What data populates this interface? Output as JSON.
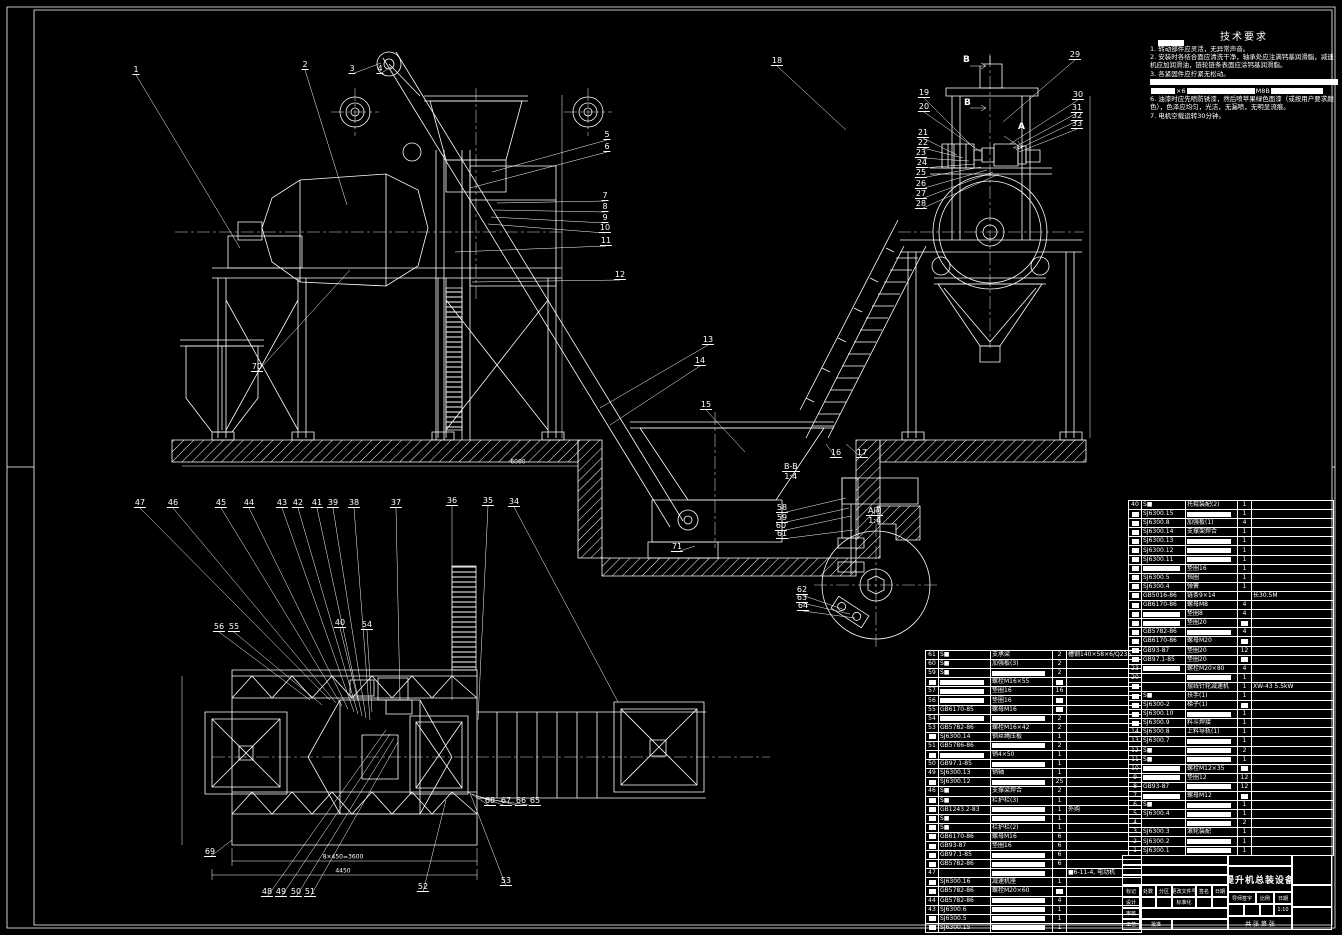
{
  "colors": {
    "background": "#000000",
    "line": "#ffffff"
  },
  "tech_requirements": {
    "title": "技术要求",
    "lines": [
      {
        "text": "1. 转动部件应灵活，无异常声音。"
      },
      {
        "text": "2. 安装时各结合面应清洗干净，轴承处应注满钙基润滑脂，减速机应加润滑油，链轮链条表面应涂钙基润滑脂。"
      },
      {
        "text": "3. 各紧固件应拧紧无松动。"
      },
      {
        "bar": true
      },
      {
        "parts": [
          {
            "b": 24
          },
          {
            "t": "×6"
          },
          {
            "b": 68
          },
          {
            "t": "M8B"
          },
          {
            "b": 52
          }
        ]
      },
      {
        "text": "6. 油漆时应先喷防锈漆，然后喷苹果绿色面漆（或按用户要求颜色），色泽应均匀，光洁，无漏喷，无明显流痕。"
      },
      {
        "text": "7. 电机空载运转30分钟。"
      }
    ]
  },
  "sections": {
    "bb_label": "B-B",
    "bb_scale": "1:4",
    "a_label": "A向",
    "a_scale": "1:4",
    "cut_letter_top": "B",
    "cut_letter_bottom": "B",
    "view_letter": "A"
  },
  "dims": [
    "6000",
    "8×450=3600",
    "4450"
  ],
  "callouts": [
    "1",
    "2",
    "3",
    "4",
    "18",
    "29",
    "5",
    "6",
    "19",
    "20",
    "30",
    "31",
    "32",
    "33",
    "7",
    "8",
    "9",
    "10",
    "11",
    "12",
    "21",
    "22",
    "23",
    "24",
    "25",
    "26",
    "27",
    "28",
    "13",
    "14",
    "15",
    "70",
    "16",
    "17",
    "71",
    "58",
    "59",
    "60",
    "61",
    "62",
    "63",
    "64",
    "47",
    "46",
    "45",
    "44",
    "43",
    "42",
    "41",
    "39",
    "38",
    "37",
    "36",
    "35",
    "34",
    "56",
    "55",
    "40",
    "54",
    "69",
    "48",
    "49",
    "50",
    "51",
    "52",
    "53",
    "68",
    "67",
    "66",
    "65"
  ],
  "bom_right": {
    "rows": [
      [
        "40",
        "S■",
        "托辊装配(2)",
        "1",
        ""
      ],
      [
        "■",
        "SJ6300.15",
        "■",
        "1",
        ""
      ],
      [
        "■",
        "SJ6300.8",
        "加强板(1)",
        "4",
        ""
      ],
      [
        "■",
        "SJ6300.14",
        "支撑架焊合",
        "1",
        ""
      ],
      [
        "■",
        "SJ6300.13",
        "■",
        "1",
        ""
      ],
      [
        "■",
        "SJ6300.12",
        "■",
        "1",
        ""
      ],
      [
        "■",
        "SJ6300.11",
        "■",
        "1",
        ""
      ],
      [
        "■",
        "■",
        "垫圈16",
        "1",
        ""
      ],
      [
        "■",
        "SJ6300.5",
        "挡圈",
        "1",
        ""
      ],
      [
        "■",
        "SJ6300.4",
        "弹簧",
        "1",
        ""
      ],
      [
        "■",
        "GB5016-86",
        "链条9×14",
        "",
        "长30.5M"
      ],
      [
        "■",
        "GB6170-86",
        "螺母M8",
        "4",
        ""
      ],
      [
        "■",
        "■",
        "垫圈8",
        "4",
        ""
      ],
      [
        "■",
        "■",
        "垫圈20",
        "■",
        ""
      ],
      [
        "■",
        "GB5782-86",
        "■",
        "4",
        ""
      ],
      [
        "■",
        "GB6170-86",
        "螺母M20",
        "■",
        ""
      ],
      [
        "■",
        "GB93-87",
        "垫圈20",
        "12",
        ""
      ],
      [
        "■",
        "GB97.1-85",
        "垫圈20",
        "■",
        ""
      ],
      [
        "23",
        "■",
        "螺栓M20×80",
        "4",
        ""
      ],
      [
        "20",
        "",
        "■",
        "1",
        ""
      ],
      [
        "■",
        "",
        "摆线针轮减速机",
        "1",
        "XW-43 5.5kW"
      ],
      [
        "■",
        "S■",
        "扶手(1)",
        "1",
        ""
      ],
      [
        "■",
        "SJ6300-2",
        "梯子(1)",
        "■",
        ""
      ],
      [
        "■",
        "SJ6300.10",
        "■",
        "1",
        ""
      ],
      [
        "■",
        "SJ6300.9",
        "料斗焊接",
        "1",
        ""
      ],
      [
        "14",
        "SJ6300.8",
        "上料导轨(1)",
        "1",
        ""
      ],
      [
        "13",
        "SJ6300.7",
        "■",
        "1",
        ""
      ],
      [
        "12",
        "S■",
        "■",
        "2",
        ""
      ],
      [
        "11",
        "S■",
        "■",
        "1",
        ""
      ],
      [
        "10",
        "■",
        "螺栓M12×35",
        "■",
        ""
      ],
      [
        "9",
        "■",
        "垫圈12",
        "12",
        ""
      ],
      [
        "8",
        "GB93-87",
        "■",
        "12",
        ""
      ],
      [
        "7",
        "■",
        "螺母M12",
        "■",
        ""
      ],
      [
        "6",
        "S■",
        "■",
        "1",
        ""
      ],
      [
        "5",
        "SJ6300.4",
        "■",
        "1",
        ""
      ],
      [
        "4",
        "",
        "■",
        "2",
        ""
      ],
      [
        "3",
        "SJ6300.3",
        "滚轮装配",
        "1",
        ""
      ],
      [
        "2",
        "SJ6300.2",
        "■",
        "1",
        ""
      ],
      [
        "1",
        "SJ6300.1",
        "■",
        "1",
        ""
      ]
    ]
  },
  "bom_center": {
    "rows": [
      [
        "61",
        "S■",
        "支承梁",
        "2",
        "槽钢140×58×6/Q235"
      ],
      [
        "60",
        "S■",
        "加强板(3)",
        "2",
        ""
      ],
      [
        "59",
        "S■",
        "■",
        "2",
        ""
      ],
      [
        "■",
        "■",
        "螺栓M16×55",
        "■",
        ""
      ],
      [
        "57",
        "■",
        "垫圈16",
        "16",
        ""
      ],
      [
        "56",
        "■",
        "垫圈16",
        "■",
        ""
      ],
      [
        "55",
        "GB6170-85",
        "螺母M16",
        "■",
        ""
      ],
      [
        "54",
        "■",
        "■",
        "2",
        ""
      ],
      [
        "53",
        "GB5782-86",
        "螺栓M16×42",
        "2",
        ""
      ],
      [
        "■",
        "SJ6300.14",
        "钢丝绳压板",
        "1",
        ""
      ],
      [
        "51",
        "GB5786-86",
        "■",
        "2",
        ""
      ],
      [
        "■",
        "■",
        "销4×50",
        "1",
        ""
      ],
      [
        "50",
        "GB97.1-85",
        "■",
        "1",
        ""
      ],
      [
        "49",
        "SJ6300.13",
        "销轴",
        "1",
        ""
      ],
      [
        "■",
        "SJ6300.12",
        "■",
        "25",
        ""
      ],
      [
        "46",
        "S■",
        "支撑梁焊合",
        "2",
        ""
      ],
      [
        "■",
        "S■",
        "栏护栏(3)",
        "1",
        ""
      ],
      [
        "■",
        "GB1243.2-83",
        "■",
        "1",
        "外购"
      ],
      [
        "■",
        "S■",
        "■",
        "1",
        ""
      ],
      [
        "■",
        "S■",
        "栏护栏(2)",
        "1",
        ""
      ],
      [
        "■",
        "GB6170-86",
        "螺母M16",
        "6",
        ""
      ],
      [
        "■",
        "GB93-87",
        "垫圈16",
        "6",
        ""
      ],
      [
        "■",
        "GB97.1-85",
        "■",
        "6",
        ""
      ],
      [
        "■",
        "GB5782-86",
        "■",
        "6",
        ""
      ],
      [
        "47",
        "",
        "■",
        "",
        "■6-11-4, 电动机"
      ],
      [
        "■",
        "SJ6300.16",
        "减速机座",
        "1",
        ""
      ],
      [
        "■",
        "GB5782-86",
        "螺栓M20×60",
        "■",
        ""
      ],
      [
        "44",
        "GB5782-86",
        "■",
        "4",
        ""
      ],
      [
        "43",
        "SJ6300.6",
        "■",
        "1",
        ""
      ],
      [
        "■",
        "SJ6300.5",
        "■",
        "1",
        ""
      ],
      [
        "■",
        "SJ6300.15",
        "■",
        "1",
        ""
      ]
    ]
  },
  "title_block": {
    "title": "提升机总装设备",
    "h1": "标记",
    "h2": "处数",
    "h3": "分区",
    "h4": "更改文件号",
    "h5": "签名",
    "h6": "日期",
    "design": "设计",
    "standard": "标准化",
    "check": "审核",
    "craft": "工艺",
    "approve": "批准",
    "advisor": "导师签字",
    "scale_label": "比例",
    "date_label": "日期",
    "scale": "1:10",
    "sheet": "共 张 第 张"
  }
}
